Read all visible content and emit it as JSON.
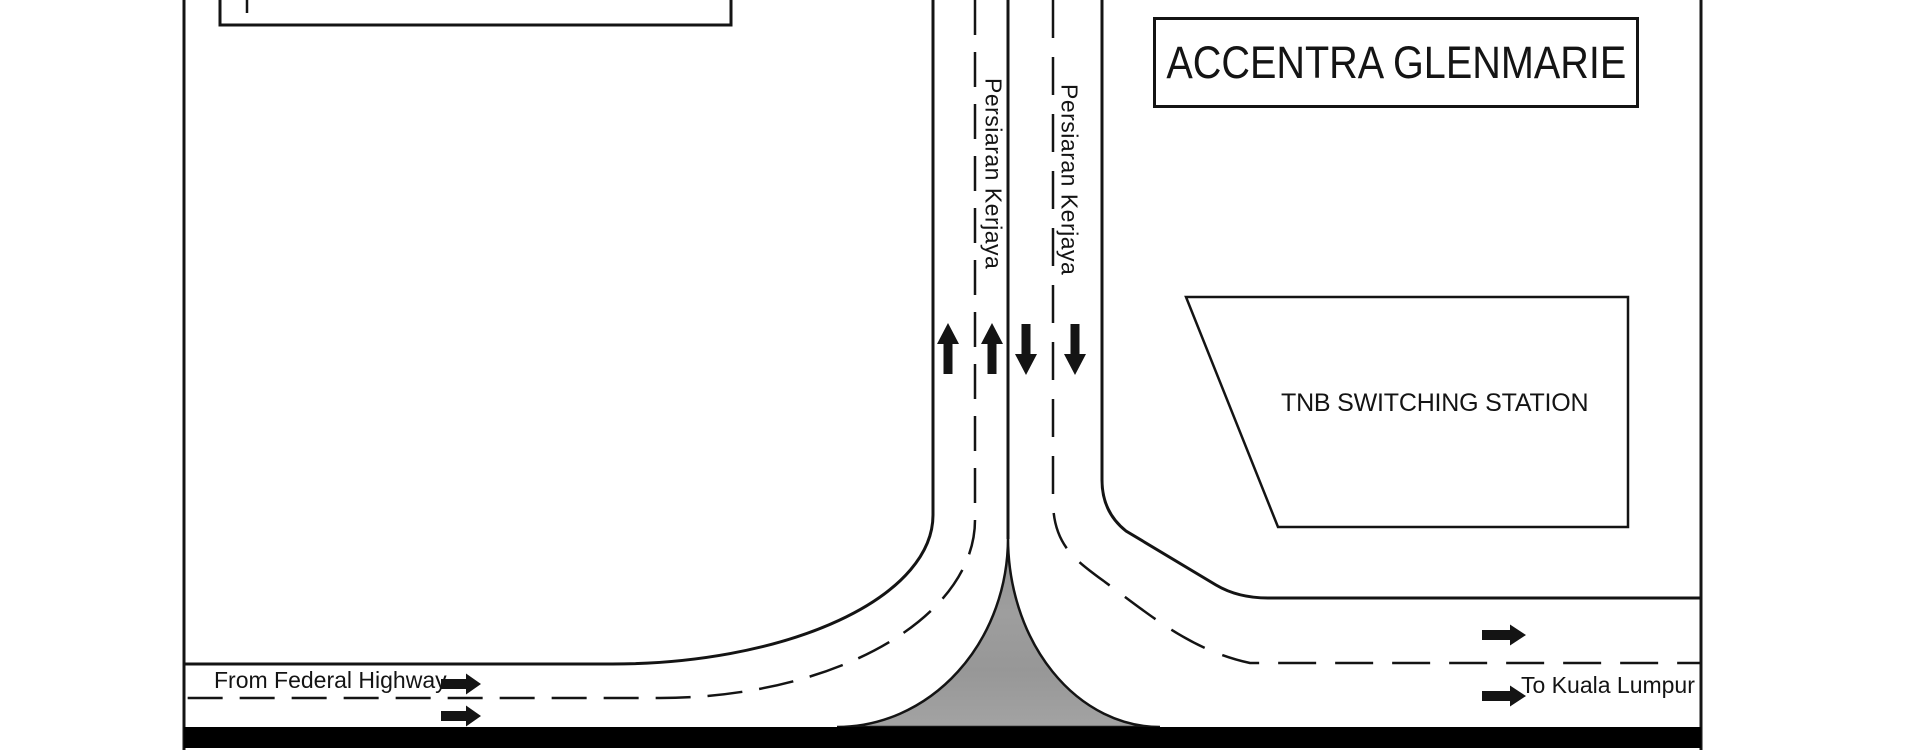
{
  "plan": {
    "development_label": "ACCENTRA GLENMARIE",
    "tnb_plot_label": "TNB SWITCHING STATION",
    "vertical_road": {
      "name_left_carriageway": "Persiaran Kerjaya",
      "name_right_carriageway": "Persiaran Kerjaya",
      "northbound_arrow_count": 2,
      "southbound_arrow_count": 2
    },
    "bottom_road": {
      "origin_label": "From Federal Highway",
      "destination_label": "To Kuala Lumpur",
      "direction": "eastbound-one-way",
      "west_leg_arrow_count": 2,
      "east_leg_arrow_count": 2
    },
    "colors": {
      "line": "#141414",
      "gore_island_fill": "#9b9b9b",
      "road_band": "#000000",
      "background": "#ffffff"
    }
  }
}
